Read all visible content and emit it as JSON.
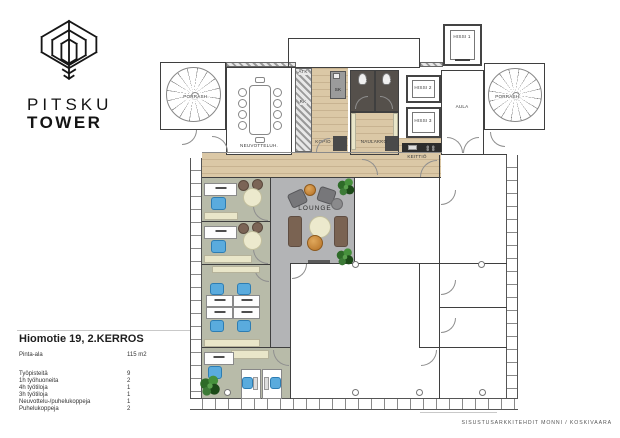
{
  "logo": {
    "line1": "PITSKU",
    "line2": "TOWER"
  },
  "info": {
    "title": "Hiomotie 19, 2.KERROS",
    "area_label": "Pinta-ala",
    "area_value": "115 m2",
    "stats": [
      {
        "label": "Työpisteitä",
        "value": "9"
      },
      {
        "label": "1h työhuoneita",
        "value": "2"
      },
      {
        "label": "4h työtiloja",
        "value": "1"
      },
      {
        "label": "3h työtiloja",
        "value": "1"
      },
      {
        "label": "Neuvottelu-/puhelukoppeja",
        "value": "1"
      },
      {
        "label": "Puhelukoppeja",
        "value": "2"
      }
    ]
  },
  "credit": "SISUSTUSARKKITEHDIT MONNI / KOSKIVAARA",
  "plan": {
    "labels": {
      "porras_left": "PORRASH.",
      "porras_right": "PORRASH.",
      "neuvottelu": "NEUVOTTELUH.",
      "atk": "ATK",
      "rk": "RK",
      "sk": "SK",
      "kopio": "KOPIO",
      "wc": "WC",
      "naulakko": "NAULAKKO",
      "hissi1": "HISSI 1",
      "hissi2": "HISSI 2",
      "hissi3": "HISSI 3",
      "keittio": "KEITTIÖ",
      "aula": "AULA",
      "lounge": "LOUNGE"
    },
    "colors": {
      "wood_floor": "#dbc8a6",
      "office_floor": "#b8bba9",
      "lounge_floor": "#b3b4b6",
      "cream_furniture": "#e9e6c9",
      "chair_blue": "#5aabdd",
      "sofa_brown": "#7a6352",
      "accent_orange": "#cd8c3c",
      "plant_green": "#3c7a36",
      "wall": "#3f3f3f",
      "kitchen_counter": "#2d2d2d"
    }
  }
}
